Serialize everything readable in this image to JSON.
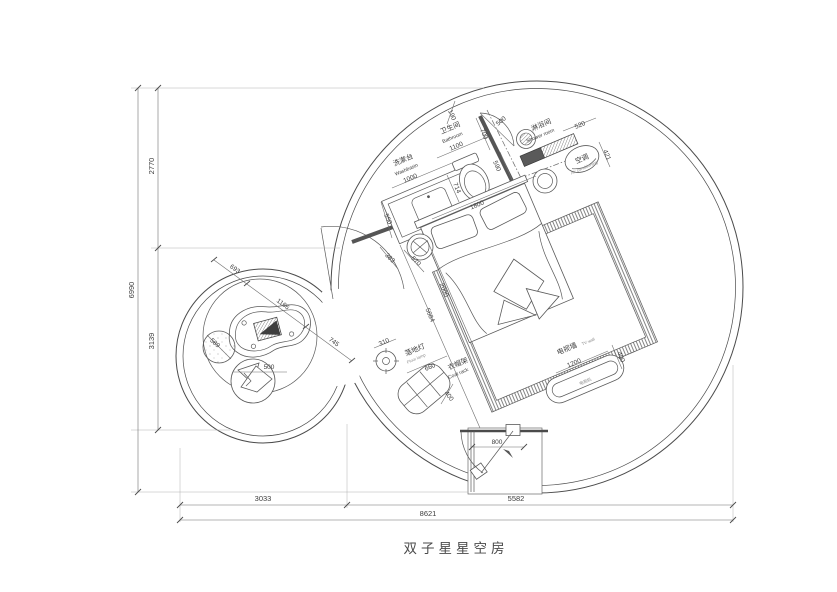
{
  "title": "双子星星空房",
  "rooms": {
    "washbasin": {
      "cn": "洗漱台",
      "en": "Washbasin",
      "dim": "1000"
    },
    "bathroom": {
      "cn": "卫生间",
      "en": "Bathroom",
      "dim": "1100"
    },
    "shower": {
      "cn": "淋浴间",
      "en": "Shower room"
    },
    "ac": {
      "cn": "空调",
      "en": "Air conditioning"
    },
    "floor_lamp": {
      "cn": "落地灯",
      "en": "Floor lamp",
      "dim": "310"
    },
    "coat_rack": {
      "cn": "衣帽架",
      "en": "Coat rack",
      "dim_w": "660",
      "dim_d": "400"
    },
    "tv_wall": {
      "cn": "电视墙",
      "en": "TV wall",
      "dim_w": "1200",
      "dim_d": "400",
      "inner": "电视机"
    }
  },
  "dims": {
    "w190": "190",
    "w700": "700",
    "w500": "500",
    "w590": "590",
    "w520": "520",
    "w421": "421",
    "w714": "714",
    "w1800": "1800",
    "w550": "550",
    "w383": "383",
    "w570": "570",
    "w2000": "2000",
    "w5684": "5684",
    "w800": "800",
    "w693": "693",
    "w1166": "1166",
    "w745": "745",
    "w589": "589",
    "w500b": "500",
    "left_total": "6990",
    "left_top": "2770",
    "left_bottom": "3139",
    "bottom_left": "3033",
    "bottom_right": "5582",
    "bottom_total": "8621"
  },
  "colors": {
    "line": "#4b4b4b",
    "dim": "#6f6f6f",
    "wall_fill": "#555555"
  }
}
